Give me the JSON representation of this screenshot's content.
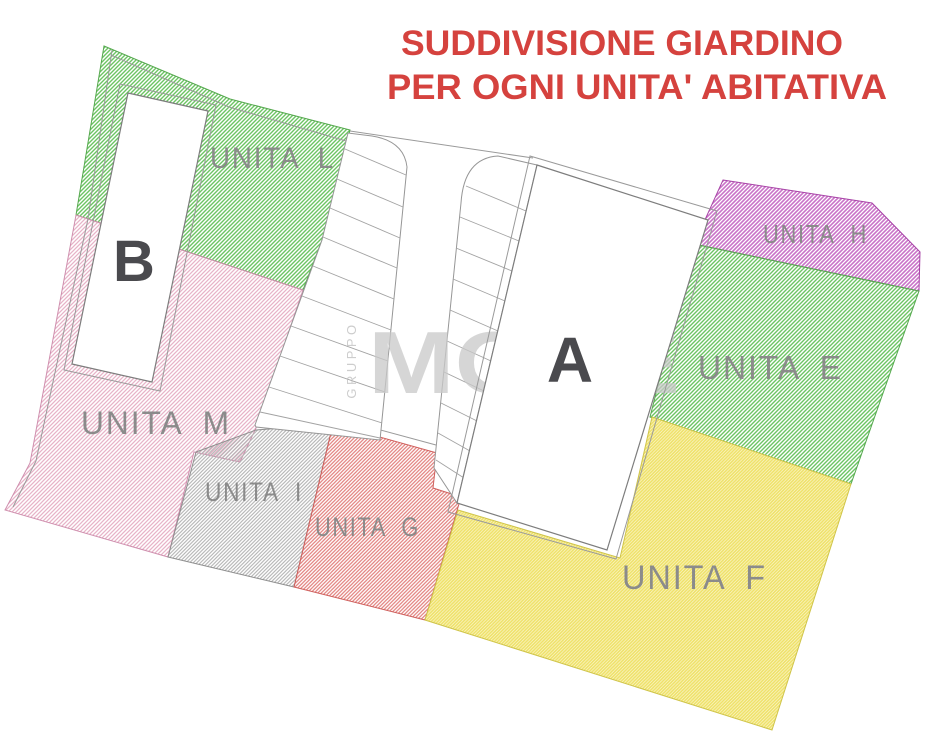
{
  "title": {
    "line1": "SUDDIVISIONE GIARDINO",
    "line2": "PER OGNI UNITA' ABITATIVA",
    "color": "#d5423e"
  },
  "watermark": {
    "vertical": "GRUPPO",
    "brand": "MORE",
    "tagline": "REAL ESTATE"
  },
  "buildings": {
    "a_label": "A",
    "b_label": "B"
  },
  "units": [
    {
      "id": "L",
      "label": "UNITA L",
      "color": "#6cc463"
    },
    {
      "id": "M",
      "label": "UNITA M",
      "color": "#e7b3c8"
    },
    {
      "id": "I",
      "label": "UNITA I",
      "color": "#adadad"
    },
    {
      "id": "G",
      "label": "UNITA G",
      "color": "#e2817e"
    },
    {
      "id": "E",
      "label": "UNITA E",
      "color": "#6cc463"
    },
    {
      "id": "H",
      "label": "UNITA H",
      "color": "#c973c8"
    },
    {
      "id": "F",
      "label": "UNITA F",
      "color": "#efe26b"
    }
  ],
  "palette": {
    "title_red": "#d5423e",
    "label_gray": "#8b8b8b",
    "building_letter": "#4a4a4e",
    "line_gray": "#9a9a9a"
  }
}
